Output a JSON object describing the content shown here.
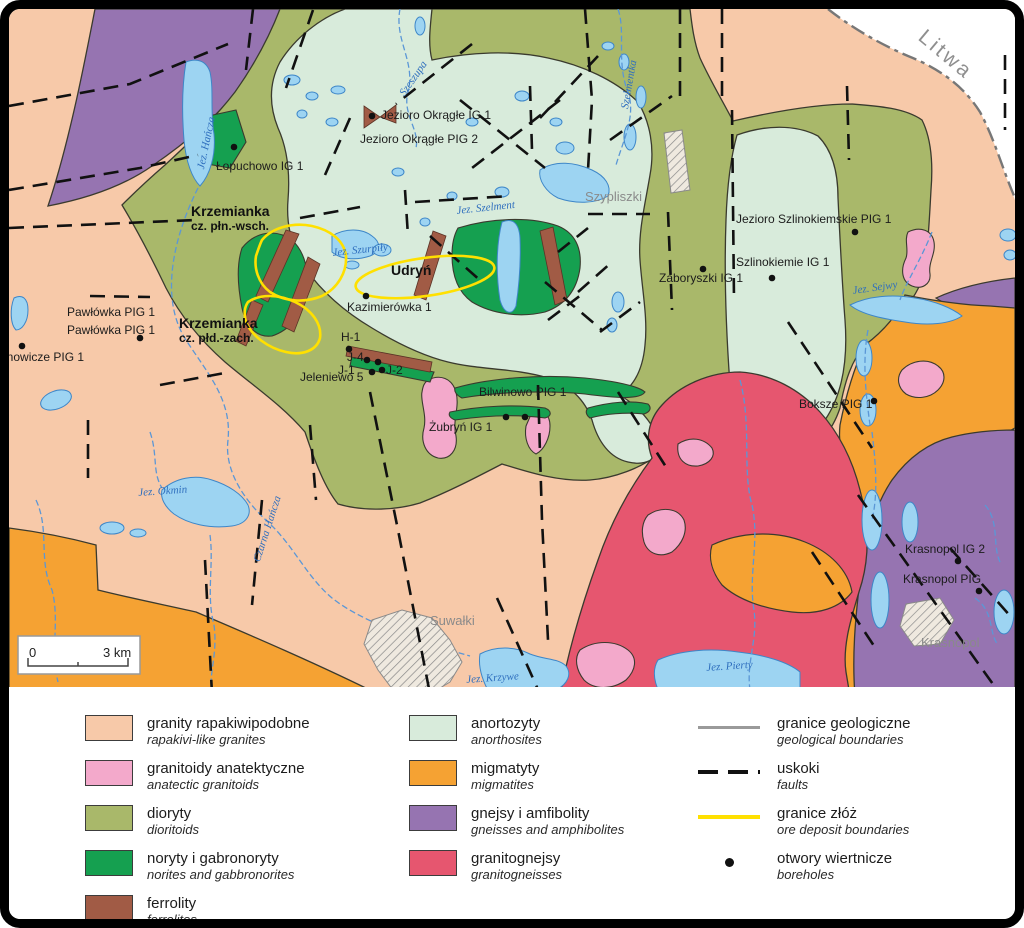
{
  "palette": {
    "rapakivi": "#F7C9A9",
    "anatectic": "#F3A9CB",
    "diorite": "#A9B86A",
    "norite": "#15A050",
    "ferrolite": "#A15B45",
    "anorthosite": "#D8EBDB",
    "migmatite": "#F5A233",
    "gneiss": "#9674B1",
    "granitogneiss": "#E6566F",
    "lake-fill": "#9DD4F2",
    "lake-stroke": "#3D86C8",
    "river": "#5B97D6",
    "fault": "#111111",
    "boundary": "#3a3a2e",
    "ore-yellow": "#FFE000",
    "border-dashdot": "#777777",
    "hatch-gray": "#8a8a8a"
  },
  "map": {
    "scale_bar": {
      "start": "0",
      "end": "3 km"
    },
    "labels": [
      {
        "text": "Litwa",
        "x": 928,
        "y": 26,
        "kind": "country",
        "rot": 40
      },
      {
        "text": "Szypliszki",
        "x": 585,
        "y": 190,
        "kind": "town",
        "rot": 0
      },
      {
        "text": "Suwałki",
        "x": 430,
        "y": 614,
        "kind": "town",
        "rot": 0
      },
      {
        "text": "Krasnopol",
        "x": 921,
        "y": 636,
        "kind": "town",
        "rot": 0
      },
      {
        "text": "Jezioro Okrągłe IG 1",
        "x": 381,
        "y": 109,
        "kind": "well",
        "rot": 0
      },
      {
        "text": "Jezioro Okrągłe PIG 2",
        "x": 360,
        "y": 133,
        "kind": "well",
        "rot": 0
      },
      {
        "text": "Łopuchowo IG 1",
        "x": 216,
        "y": 160,
        "kind": "well",
        "rot": 0
      },
      {
        "text": "Pawłówka PIG 1",
        "x": 67,
        "y": 306,
        "kind": "well",
        "rot": 0
      },
      {
        "text": "Pawłówka PIG 1",
        "x": 67,
        "y": 324,
        "kind": "well",
        "rot": 0
      },
      {
        "text": "anowicze PIG 1",
        "x": 0,
        "y": 351,
        "kind": "well",
        "rot": 0
      },
      {
        "text": "Kazimierówka 1",
        "x": 347,
        "y": 301,
        "kind": "well",
        "rot": 0
      },
      {
        "text": "H-1",
        "x": 341,
        "y": 331,
        "kind": "well",
        "rot": 0
      },
      {
        "text": "J-4",
        "x": 347,
        "y": 351,
        "kind": "well",
        "rot": 0
      },
      {
        "text": "J-1",
        "x": 338,
        "y": 364,
        "kind": "well",
        "rot": 0
      },
      {
        "text": "J-2",
        "x": 386,
        "y": 364,
        "kind": "well",
        "rot": 0
      },
      {
        "text": "Jeleniewo 5",
        "x": 300,
        "y": 371,
        "kind": "well",
        "rot": 0
      },
      {
        "text": "Bilwinowo PIG 1",
        "x": 479,
        "y": 386,
        "kind": "well",
        "rot": 0
      },
      {
        "text": "Żubryń IG 1",
        "x": 429,
        "y": 421,
        "kind": "well",
        "rot": 0
      },
      {
        "text": "Zaboryszki IG 1",
        "x": 659,
        "y": 272,
        "kind": "well",
        "rot": 0
      },
      {
        "text": "Szlinokiemie IG 1",
        "x": 736,
        "y": 256,
        "kind": "well",
        "rot": 0
      },
      {
        "text": "Jezioro Szlinokiemskie PIG 1",
        "x": 736,
        "y": 213,
        "kind": "well",
        "rot": 0
      },
      {
        "text": "Boksze PIG 1",
        "x": 799,
        "y": 398,
        "kind": "well",
        "rot": 0
      },
      {
        "text": "Krasnopol IG 2",
        "x": 905,
        "y": 543,
        "kind": "well",
        "rot": 0
      },
      {
        "text": "Krasnopol PIG",
        "x": 903,
        "y": 573,
        "kind": "well",
        "rot": 0
      },
      {
        "text": "Krzemianka",
        "x": 191,
        "y": 204,
        "kind": "well-bold",
        "rot": 0
      },
      {
        "text": "cz. płn.-wsch.",
        "x": 191,
        "y": 220,
        "kind": "well-bold-sm",
        "rot": 0
      },
      {
        "text": "Krzemianka",
        "x": 179,
        "y": 316,
        "kind": "well-bold",
        "rot": 0
      },
      {
        "text": "cz. płd.-zach.",
        "x": 179,
        "y": 332,
        "kind": "well-bold-sm",
        "rot": 0
      },
      {
        "text": "Udryń",
        "x": 391,
        "y": 263,
        "kind": "well-bold",
        "rot": 0
      },
      {
        "text": "Jez. Hańcza",
        "x": 196,
        "y": 168,
        "kind": "water",
        "rot": -78
      },
      {
        "text": "Jez. Szurpiły",
        "x": 332,
        "y": 248,
        "kind": "water",
        "rot": -6
      },
      {
        "text": "Jez. Szelment",
        "x": 456,
        "y": 206,
        "kind": "water",
        "rot": -6
      },
      {
        "text": "Jez. Sejwy",
        "x": 852,
        "y": 286,
        "kind": "water",
        "rot": -8
      },
      {
        "text": "Jez. Okmin",
        "x": 138,
        "y": 488,
        "kind": "water",
        "rot": -4
      },
      {
        "text": "Czarna Hańcza",
        "x": 252,
        "y": 560,
        "kind": "water",
        "rot": -72
      },
      {
        "text": "Jez. Krzywe",
        "x": 466,
        "y": 675,
        "kind": "water",
        "rot": -4
      },
      {
        "text": "Jez. Pierty",
        "x": 706,
        "y": 663,
        "kind": "water",
        "rot": -4
      },
      {
        "text": "Szeszupa",
        "x": 398,
        "y": 92,
        "kind": "water",
        "rot": -55
      },
      {
        "text": "Szelmentka",
        "x": 620,
        "y": 108,
        "kind": "water",
        "rot": -80
      }
    ],
    "boreholes": [
      {
        "x": 372,
        "y": 116
      },
      {
        "x": 234,
        "y": 147
      },
      {
        "x": 140,
        "y": 338
      },
      {
        "x": 22,
        "y": 346
      },
      {
        "x": 366,
        "y": 296
      },
      {
        "x": 349,
        "y": 349
      },
      {
        "x": 367,
        "y": 360
      },
      {
        "x": 378,
        "y": 362
      },
      {
        "x": 372,
        "y": 372
      },
      {
        "x": 382,
        "y": 370
      },
      {
        "x": 506,
        "y": 417
      },
      {
        "x": 525,
        "y": 417
      },
      {
        "x": 703,
        "y": 269
      },
      {
        "x": 772,
        "y": 278
      },
      {
        "x": 855,
        "y": 232
      },
      {
        "x": 874,
        "y": 401
      },
      {
        "x": 958,
        "y": 561
      },
      {
        "x": 979,
        "y": 591
      }
    ]
  },
  "legend": {
    "rock_units": [
      {
        "pl": "granity rapakiwipodobne",
        "en": "rapakivi-like granites",
        "color": "#F7C9A9"
      },
      {
        "pl": "granitoidy anatektyczne",
        "en": "anatectic granitoids",
        "color": "#F3A9CB"
      },
      {
        "pl": "dioryty",
        "en": "dioritoids",
        "color": "#A9B86A"
      },
      {
        "pl": "noryty i gabronoryty",
        "en": "norites and gabbronorites",
        "color": "#15A050"
      },
      {
        "pl": "ferrolity",
        "en": "ferrolites",
        "color": "#A15B45"
      },
      {
        "pl": "anortozyty",
        "en": "anorthosites",
        "color": "#D8EBDB"
      },
      {
        "pl": "migmatyty",
        "en": "migmatites",
        "color": "#F5A233"
      },
      {
        "pl": "gnejsy i amfibolity",
        "en": "gneisses and amphibolites",
        "color": "#9674B1"
      },
      {
        "pl": "granitognejsy",
        "en": "granitogneisses",
        "color": "#E6566F"
      }
    ],
    "symbols": [
      {
        "pl": "granice geologiczne",
        "en": "geological boundaries",
        "type": "line-gray"
      },
      {
        "pl": "uskoki",
        "en": "faults",
        "type": "line-dashed"
      },
      {
        "pl": "granice złóż",
        "en": "ore deposit boundaries",
        "type": "line-yellow"
      },
      {
        "pl": "otwory wiertnicze",
        "en": "boreholes",
        "type": "dot-sym"
      }
    ]
  }
}
